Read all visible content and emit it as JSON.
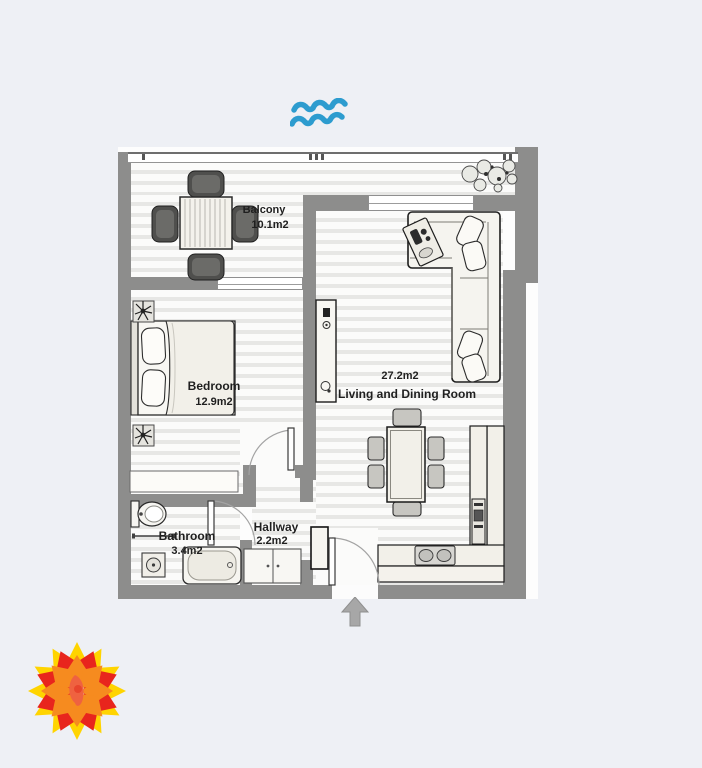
{
  "page": {
    "background": "#eef0f5"
  },
  "floorplan": {
    "wall_color": "#8d8d8c",
    "rooms": [
      {
        "name": "Balcony",
        "area": "10.1m2"
      },
      {
        "name": "Bedroom",
        "area": "12.9m2"
      },
      {
        "name": "Bathroom",
        "area": "3.4m2"
      },
      {
        "name": "Hallway",
        "area": "2.2m2"
      },
      {
        "name": "Living and Dining Room",
        "area": "27.2m2"
      }
    ]
  },
  "icons": {
    "waves": "water-waves-icon",
    "entry_arrow": "entry-direction-arrow-icon",
    "logo": "flower-logo"
  },
  "colors": {
    "waves_blue": "#2d9ccf",
    "arrow_gray": "#a7a7a7",
    "logo_yellow": "#ffd400",
    "logo_orange": "#f68b1f",
    "logo_red": "#e8251d",
    "logo_center": "#ef6240"
  }
}
